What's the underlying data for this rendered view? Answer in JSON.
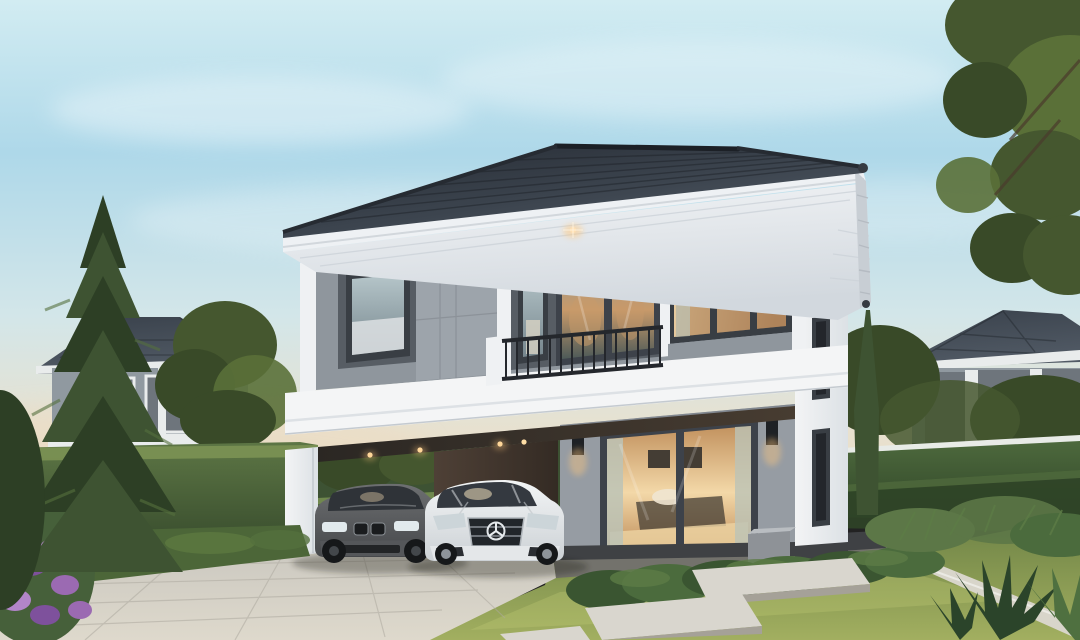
{
  "scene": {
    "type": "architectural-exterior-rendering",
    "description": "Photorealistic dusk rendering of a modern two-storey detached house with grey panel facade, dark hip tile roof, first-floor carport containing a grey BMW sedan and a white Mercedes coupe, lit interior behind a large sliding glass door, balcony with black railing, hedge fences, neighbouring single-storey houses, tall pine tree at left, cypress trees at right, paver driveway, lawn with concrete stepping slabs and purple flowering shrub",
    "time_of_day": "dusk",
    "objects": [
      "sky",
      "clouds",
      "sunset-horizon-glow",
      "overhanging-tree-branch",
      "neighbor-house-left",
      "neighbor-house-right",
      "deciduous-tree",
      "hedge-fence-left",
      "hedge-fence-right",
      "cypress-trees",
      "pine-tree",
      "main-house",
      "hip-tile-roof",
      "eave-soffit",
      "soffit-downlight",
      "second-floor-facade",
      "balcony",
      "balcony-railing",
      "corner-window",
      "carport",
      "carport-downlights",
      "bmw-sedan-grey",
      "mercedes-coupe-white",
      "first-floor-wall",
      "sliding-glass-door",
      "wall-sconces",
      "utility-box",
      "driveway-pavers",
      "dark-paver-band",
      "lawn",
      "stepping-slabs",
      "concrete-curb",
      "shrub-row",
      "spiky-plants",
      "purple-flower-bush"
    ]
  },
  "palette": {
    "sky-top": "#d2ecf2",
    "sky-blue": "#aed8e9",
    "sky-low": "#d3e6e9",
    "sky-warm": "#e8e1cf",
    "sky-horizon": "#ecdcc2",
    "cloud": "#ffffff",
    "roof-dark": "#242931",
    "roof-mid": "#3a424c",
    "roof-light": "#535c67",
    "ridge": "#1c2026",
    "fascia": "#eef1f4",
    "soffit-1": "#f3f5f7",
    "soffit-2": "#d2d8de",
    "side-fascia": "#c8ced4",
    "gutter-cap": "#363b42",
    "wall-gray": "#8f969d",
    "panel-light": "#9da4ab",
    "panel-dark": "#575d64",
    "trim-white": "#eff1f3",
    "parapet-1": "#f4f5f6",
    "parapet-2": "#dde1e5",
    "frame-dark": "#393e44",
    "recess-1": "#2b2723",
    "recess-2": "#473c31",
    "glass-cool-1": "#b6c6ca",
    "glass-cool-2": "#76868d",
    "balc-glass-1": "#8c9898",
    "balc-glass-2": "#4d5a58",
    "warm-glass-1": "#eed3a6",
    "warm-glass-2": "#b3875f",
    "reflect-warm": "#c89a6a",
    "interior-dark": "#443d34",
    "railing": "#24272c",
    "dark-wall-recess": "#41454a",
    "carport-green": "#3d5233",
    "carport-hedge": "#506b3f",
    "carport-floor-1": "#98938a",
    "carport-floor-2": "#b6b2a9",
    "carport-brown-1": "#4e4036",
    "carport-brown-2": "#342b24",
    "wall-first": "#969ca3",
    "plinth": "#3f4144",
    "door-frame": "#3d424a",
    "door-glow-1": "#f3d8a8",
    "door-glow-2": "#c2925f",
    "curtain": "#bcc3b6",
    "sconce": "#1e2125",
    "glow-warm": "#ffc87d",
    "white-wall-1": "#f3f4f5",
    "white-wall-2": "#dce1e5",
    "slit-glass": "#23262b",
    "box-gray": "#8e9297",
    "box-top": "#b9bdc1",
    "hedge-l1": "#5d7645",
    "hedge-l2": "#35492b",
    "hedge-top": "#7e9455",
    "hedge-r1": "#4d693d",
    "hedge-r2": "#2f4427",
    "hedge-cap": "#e8ebe7",
    "lawn-1": "#6d8245",
    "lawn-2": "#a2af60",
    "lawn-streak": "#c2cc78",
    "drive-1": "#cbc8c0",
    "drive-2": "#ded9cc",
    "paver-line": "#aeaaa0",
    "paver-band": "#73726c",
    "slab": "#d9d6ce",
    "slab-edge": "#a5a198",
    "curb": "#d8d5ca",
    "pine-1": "#3e5332",
    "pine-2": "#2d3f25",
    "pine-hi": "#55703e",
    "trunk": "#594a38",
    "tree-1": "#45572f",
    "tree-2": "#5a7038",
    "tree-3": "#394a28",
    "shrub-1": "#3a5531",
    "shrub-2": "#4b6b3d",
    "shrub-hi": "#5d7c46",
    "fern": "#5c7747",
    "spiky": "#2b442a",
    "spiky-hi": "#4f7040",
    "flower-1": "#9b6ab2",
    "flower-2": "#b285c9",
    "flower-3": "#7e519c",
    "nb-roof-1": "#39414b",
    "nb-roof-2": "#515a65",
    "nb-wall": "#9099a0",
    "nb-white": "#e9ecec",
    "nb-glass": "#6e757c",
    "nb-dark-band": "#3b3f43",
    "bmw-1": "#6d6f71",
    "bmw-2": "#46484b",
    "bmw-glass": "#2f3338",
    "wheel": "#16181a",
    "hub": "#43474b",
    "mb-1": "#f3f5f6",
    "mb-2": "#ccd1d5",
    "mb-glass": "#343940",
    "chrome": "#b0b6bb",
    "headlight": "#eaf2f6",
    "shadow": "#15170f"
  }
}
